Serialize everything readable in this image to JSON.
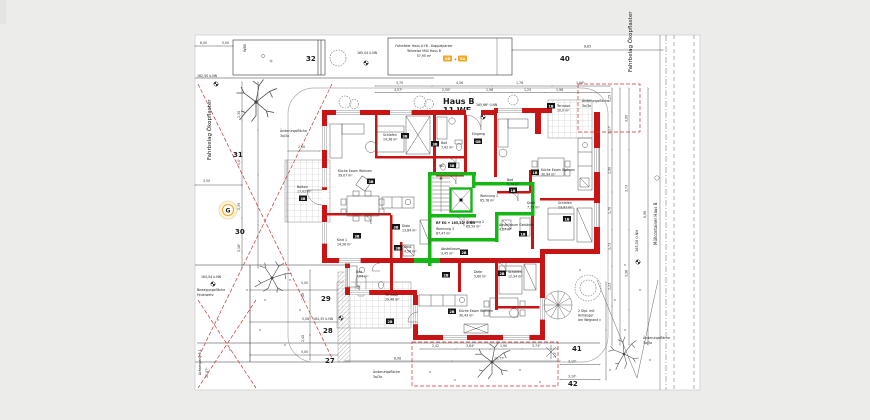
{
  "colors": {
    "wall_red": "#c81414",
    "unit_green": "#17b617",
    "accent_orange": "#f5a623",
    "dash_red": "#cc3333"
  },
  "title": {
    "l1": "Haus B",
    "l2": "11 WE",
    "level": "165,66⁵ ü.NN"
  },
  "chips": {
    "b1": "1B",
    "b2": "2B",
    "b3": "3B",
    "gb": "GB",
    "ga": "GA",
    "plus": "+",
    "g": "G"
  },
  "top": {
    "note1": "Fahrräder Haus A+B - Doppelparker",
    "note2": "Teilweise Müll Haus B",
    "note3": "57,95 m²",
    "level1": "165,04 ü.NN",
    "level2": "162,50 ü.NN",
    "n32": "32",
    "n40": "40",
    "wbs": "WBS",
    "d600": "6,00",
    "d500": "5,00",
    "d885": "8,85",
    "chain1": [
      "3,70",
      "4,56",
      "1,76",
      "1,06⁵"
    ],
    "chain2": [
      "4,57⁵",
      "2,50⁵",
      "1,98",
      "1,25",
      "1,98"
    ]
  },
  "left": {
    "road": "Fahrbelag Ökopflaster",
    "p31": "31",
    "p30": "30",
    "d350": "3,50",
    "vdims": [
      "2,30",
      "5,0⁵",
      "2,39",
      "5,16⁵"
    ]
  },
  "firezone": {
    "level": "164,54 ü.NN",
    "l1": "Bewegungsfläche",
    "l2": "Feuerwehr",
    "side": "Achsengang 5.1",
    "sidedim": "10,07⁵"
  },
  "parking": {
    "p29": "29",
    "p28": "28",
    "p27": "27",
    "level": "164,35 ü.NN",
    "d500a": "5,00",
    "d508": "5,08",
    "d500b": "5,00",
    "v240a": "2,40",
    "v240b": "2,40",
    "we": "WE"
  },
  "units": {
    "w1n": "Wohnung 1",
    "w1a": "65,78 m²",
    "w2n": "Wohnung 2",
    "w2a": "89,59 m²",
    "w3n": "Wohnung 3",
    "w3a": "87,47 m²",
    "rf": "RF EG + 165,52⁵ ü.NN",
    "eingang": "Eingang"
  },
  "rooms": {
    "w3": {
      "schlafen_n": "Schlafen",
      "schlafen_a": "14,38 m²",
      "bad_n": "Bad",
      "bad_a": "7,42 m²",
      "wc": "WC",
      "kueche_n": "Küche Essen Wohnen",
      "kueche_a": "39,07 m²",
      "balkon_n": "Balkon",
      "balkon_a": "17,02 m²",
      "kind_n": "Kind 1",
      "kind_a": "14,26 m²",
      "diele_n": "Diele",
      "diele_a": "13,84 m²",
      "abst_n": "Abst.",
      "abst_a": "4,58 m²"
    },
    "w1": {
      "terr_n": "Terrasse",
      "terr_a": "10,0 m²",
      "kueche_n": "Küche Essen Wohnen",
      "kueche_a": "30,94 m²",
      "schlafen_n": "Schlafen",
      "schlafen_a": "13,91 m²",
      "bad_n": "Bad",
      "bad_a": "5,74 m²",
      "diele_n": "Diele",
      "diele_a": "7,77 m²",
      "abst_n": "Abstellraum Getränke",
      "abst_a": "4,27 m²"
    },
    "w2": {
      "bad_n": "Bad",
      "bad_a": "7,04 m²",
      "diele_n": "Diele",
      "diele_a": "5,60 m²",
      "schlafen_n": "Schlafen",
      "schlafen_a": "12,94 m²",
      "kueche_n": "Küche Essen Wohnen",
      "kueche_a": "30,43 m²",
      "terr_n": "Terrasse",
      "terr_a": "29,48 m²",
      "abst_n": "Abstellraum",
      "abst_a": "3,45 m²"
    }
  },
  "right": {
    "road": "Fahrbelag Ökopflaster",
    "muell": "Müllcontainer Haus B",
    "level": "165,50 ü.NN",
    "vd1": [
      "1,25",
      "3,17⁵",
      "2,98",
      "1,78",
      "1,73",
      "2,23"
    ],
    "vd2": [
      "3,00",
      "3,73",
      "3,36"
    ],
    "d898": "8,98"
  },
  "bottom": {
    "chain": [
      "2,42",
      "3,84⁵",
      "1,90",
      "3,73⁵"
    ],
    "d898": "8,98",
    "d1077": "10,77⁵",
    "n41": "41",
    "n42": "42",
    "d310a": "3,10⁵",
    "d310b": "3,10⁵",
    "d255": "2,5⁵",
    "note1": "2 Stpl. mit",
    "note2": "Anhänger",
    "note3": "am Wegrand"
  },
  "aend": {
    "l1": "Änderungsfläche",
    "l2": "3a/3a",
    "d200": "2,00"
  }
}
